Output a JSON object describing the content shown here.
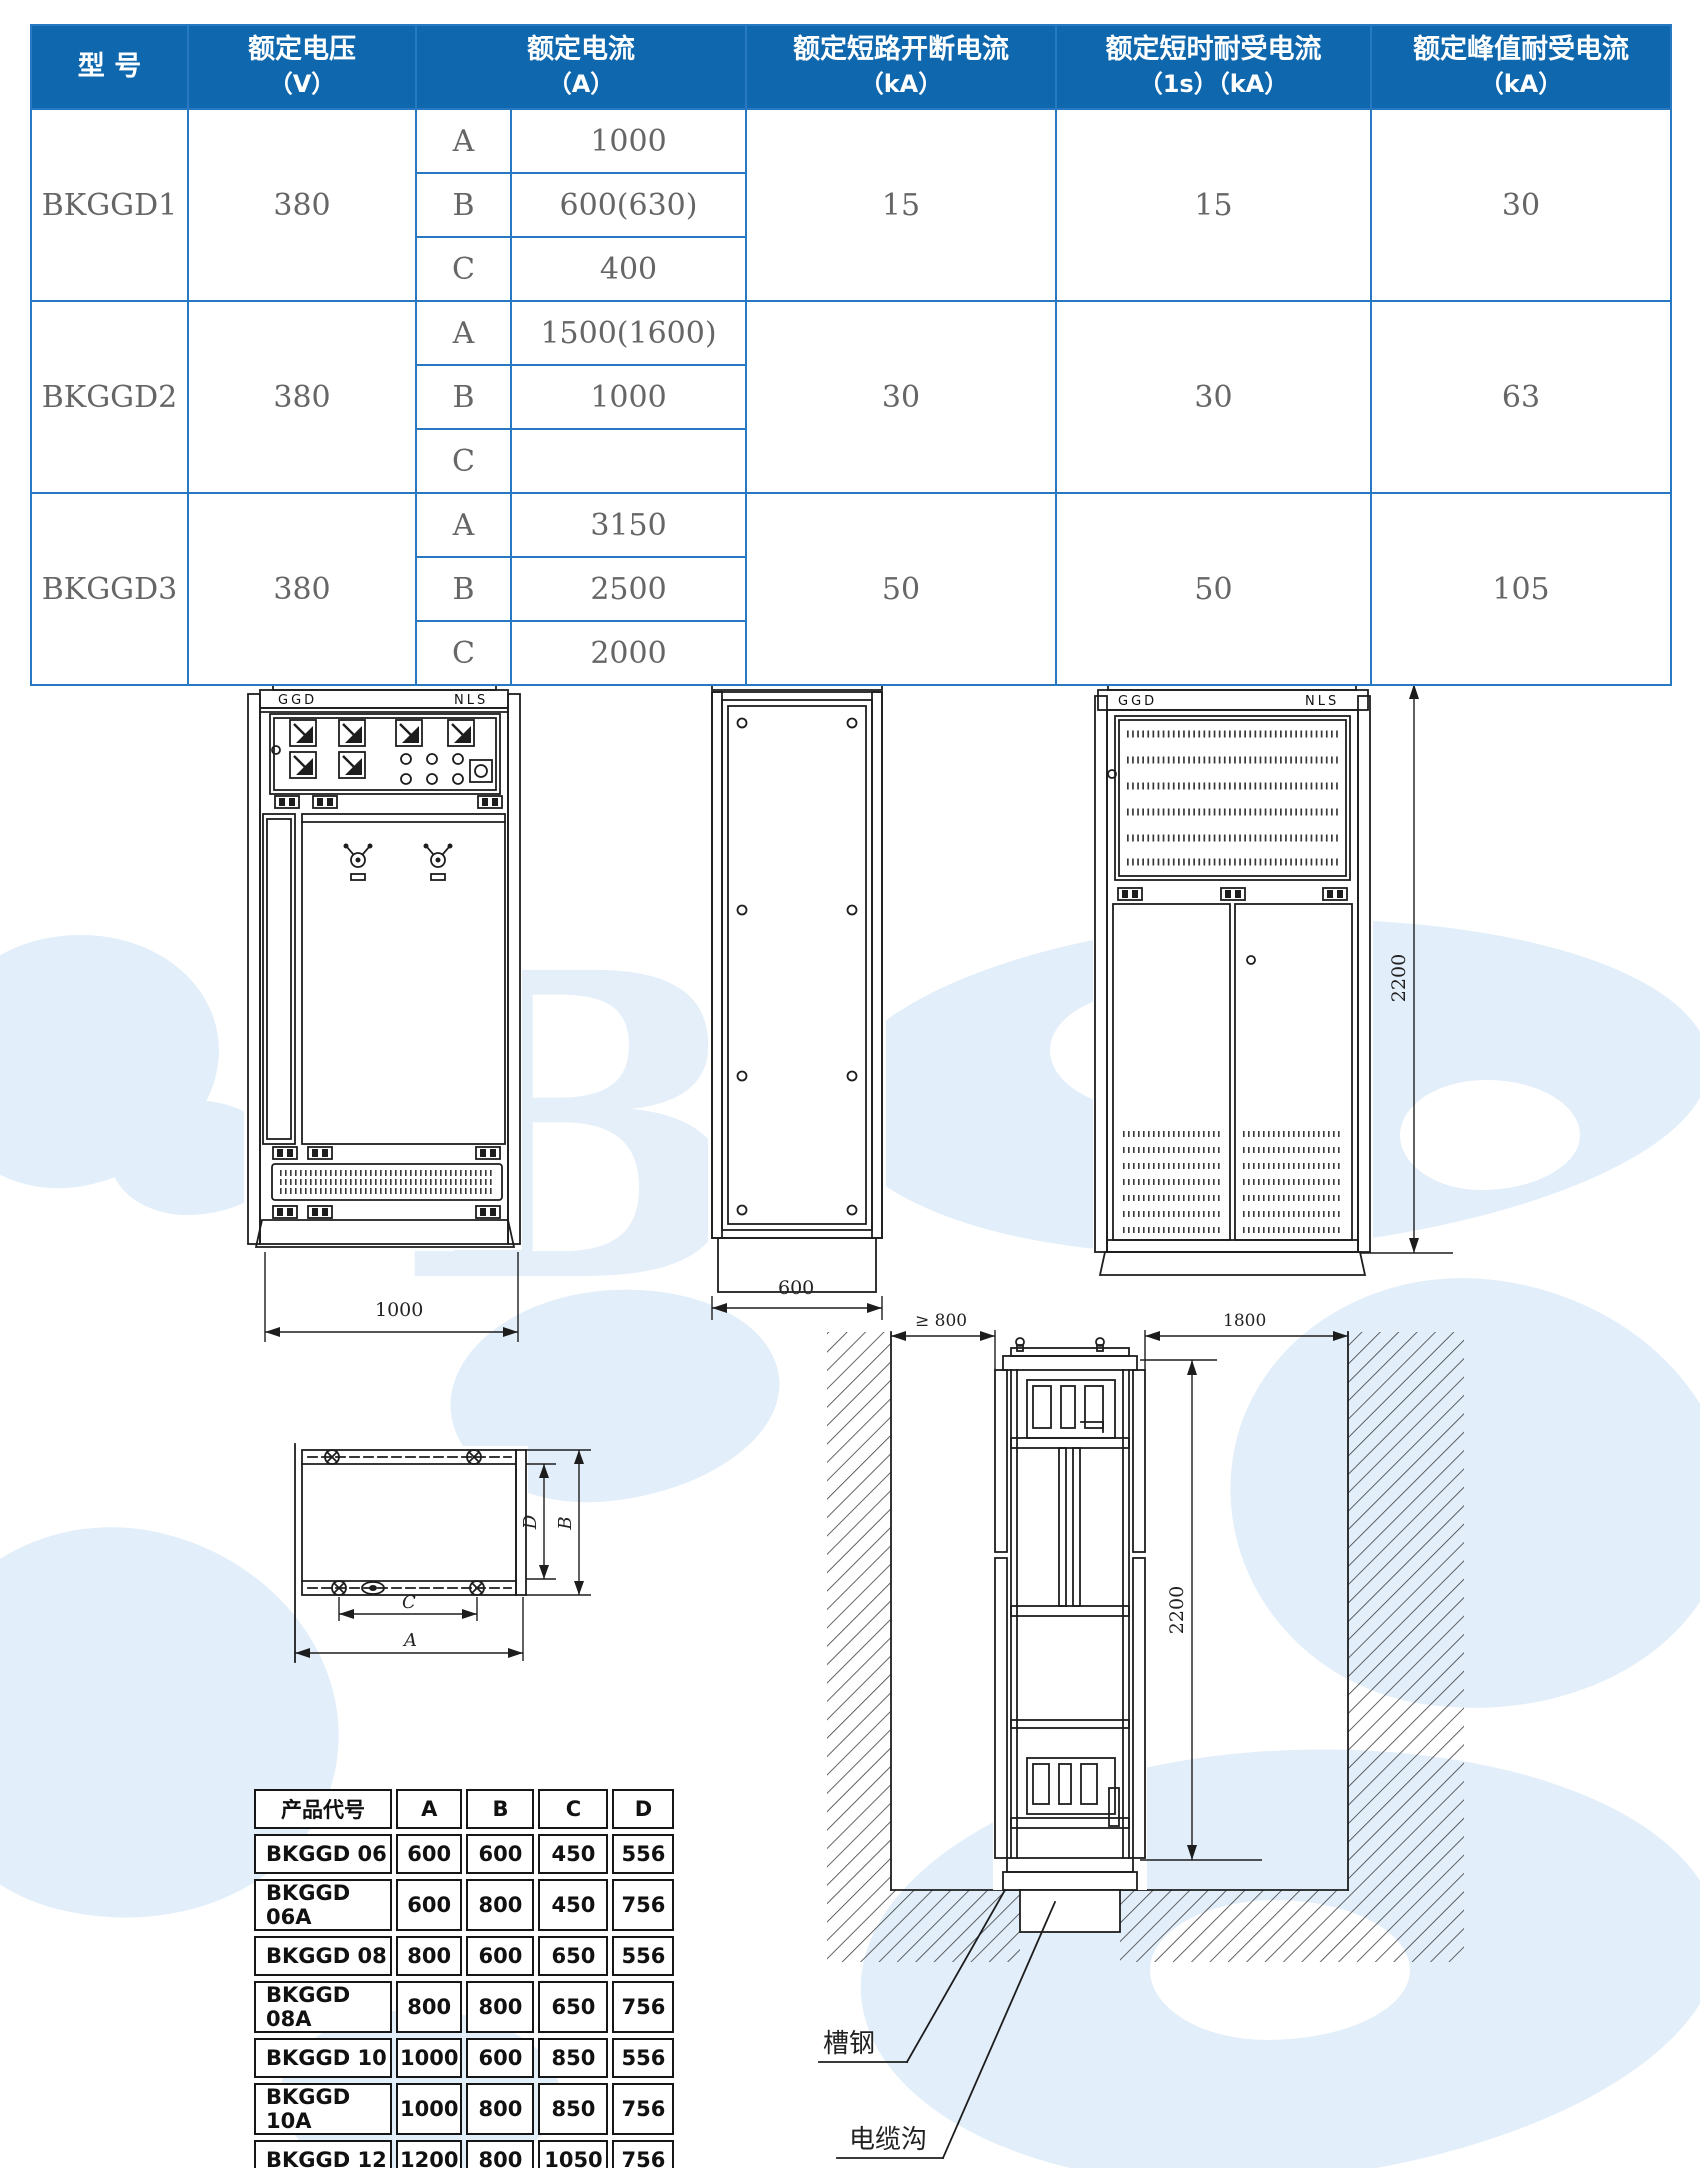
{
  "spec_table": {
    "headers": [
      {
        "l1": "型  号",
        "l2": ""
      },
      {
        "l1": "额定电压",
        "l2": "（V）"
      },
      {
        "l1": "额定电流",
        "l2": "（A）"
      },
      {
        "l1": "额定短路开断电流",
        "l2": "（kA）"
      },
      {
        "l1": "额定短时耐受电流",
        "l2": "（1s）（kA）"
      },
      {
        "l1": "额定峰值耐受电流",
        "l2": "（kA）"
      }
    ],
    "rows": [
      {
        "model": "BKGGD1",
        "voltage": "380",
        "a_label": "A",
        "a_value": "1000",
        "b_label": "B",
        "b_value": "600(630)",
        "c_label": "C",
        "c_value": "400",
        "breaking": "15",
        "withstand": "15",
        "peak": "30"
      },
      {
        "model": "BKGGD2",
        "voltage": "380",
        "a_label": "A",
        "a_value": "1500(1600)",
        "b_label": "B",
        "b_value": "1000",
        "c_label": "C",
        "c_value": "",
        "breaking": "30",
        "withstand": "30",
        "peak": "63"
      },
      {
        "model": "BKGGD3",
        "voltage": "380",
        "a_label": "A",
        "a_value": "3150",
        "b_label": "B",
        "b_value": "2500",
        "c_label": "C",
        "c_value": "2000",
        "breaking": "50",
        "withstand": "50",
        "peak": "105"
      }
    ]
  },
  "drawings": {
    "front": {
      "brand_left": "GGD",
      "brand_right": "NLS",
      "width_dim": "1000"
    },
    "side": {
      "width_dim": "600"
    },
    "rear": {
      "brand_left": "GGD",
      "brand_right": "NLS",
      "height_dim": "2200"
    },
    "plan": {
      "dim_d": "D",
      "dim_b": "B",
      "dim_c": "C",
      "dim_a": "A"
    },
    "install": {
      "left_gap": "≥ 800",
      "right_gap": "1800",
      "height_dim": "2200",
      "channel_steel": "槽钢",
      "cable_trench": "电缆沟"
    }
  },
  "dim_table": {
    "header": [
      "产品代号",
      "A",
      "B",
      "C",
      "D"
    ],
    "rows": [
      [
        "BKGGD 06",
        "600",
        "600",
        "450",
        "556"
      ],
      [
        "BKGGD 06A",
        "600",
        "800",
        "450",
        "756"
      ],
      [
        "BKGGD 08",
        "800",
        "600",
        "650",
        "556"
      ],
      [
        "BKGGD 08A",
        "800",
        "800",
        "650",
        "756"
      ],
      [
        "BKGGD 10",
        "1000",
        "600",
        "850",
        "556"
      ],
      [
        "BKGGD 10A",
        "1000",
        "800",
        "850",
        "756"
      ],
      [
        "BKGGD 12",
        "1200",
        "800",
        "1050",
        "756"
      ]
    ]
  },
  "colors": {
    "header_bg": "#0f67ad",
    "grid_blue": "#2779c2",
    "body_text": "#666666",
    "line": "#1d1d1d",
    "watermark": "#e2eef9"
  }
}
